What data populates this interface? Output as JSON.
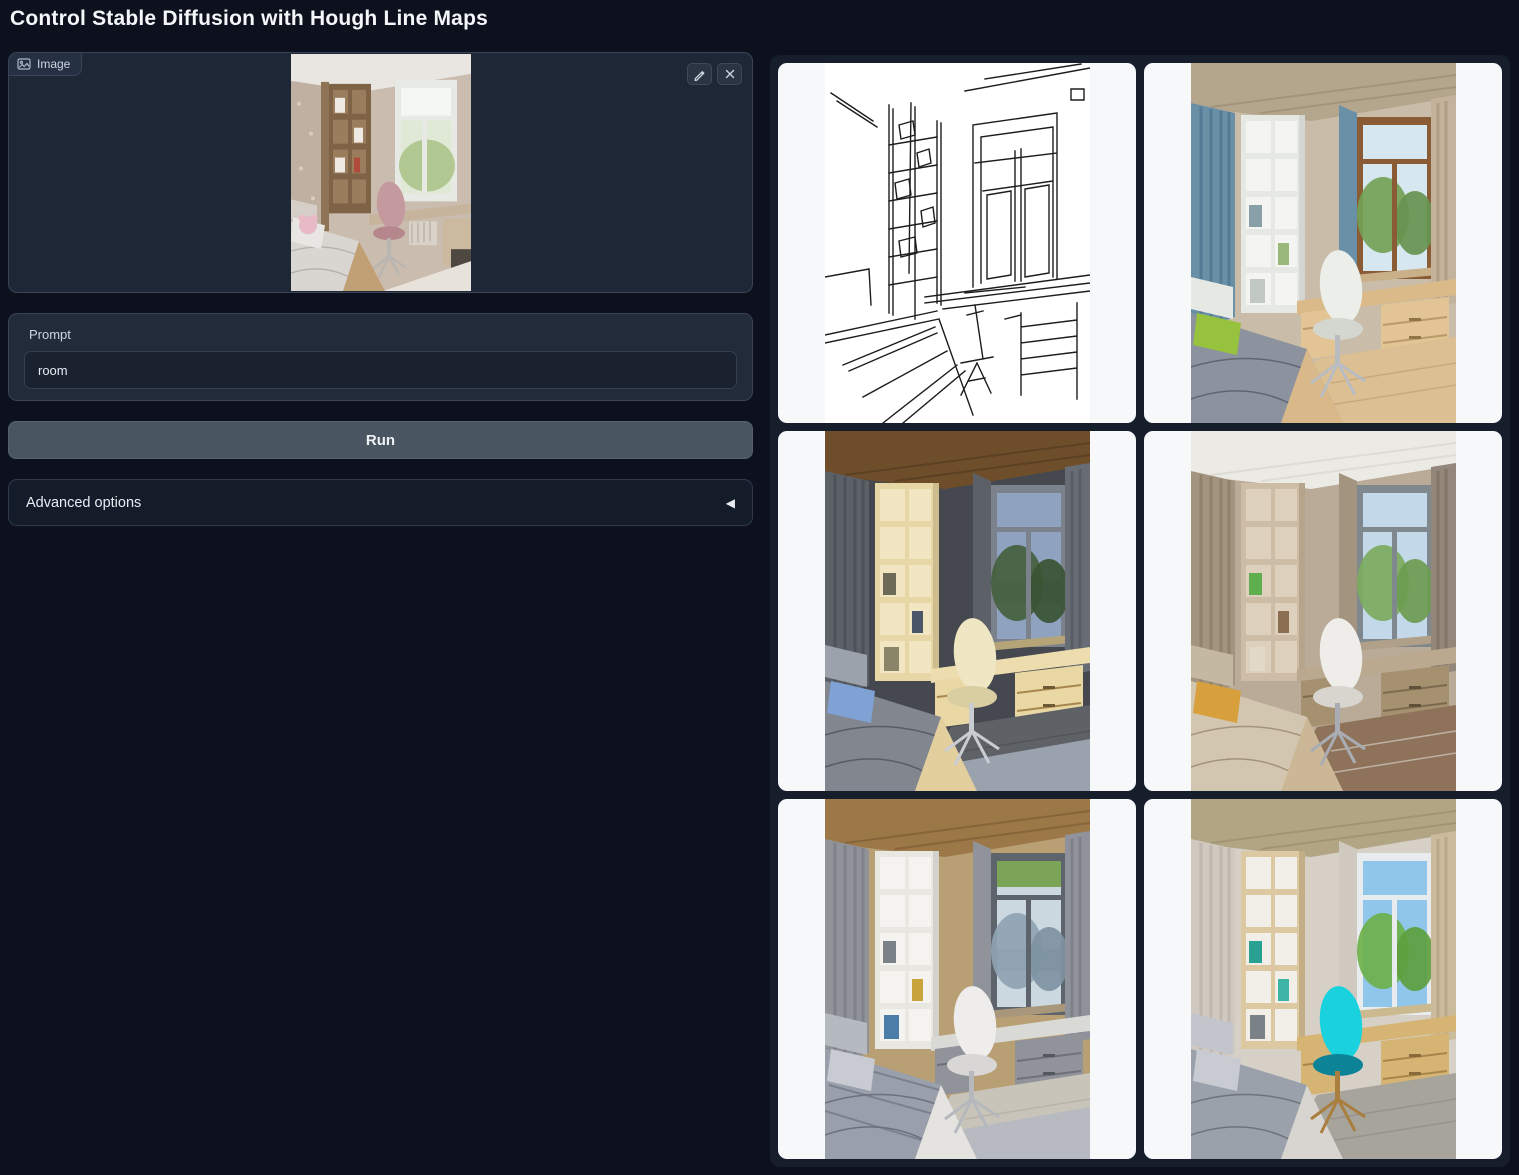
{
  "app": {
    "title": "Control Stable Diffusion with Hough Line Maps"
  },
  "image_input": {
    "label": "Image"
  },
  "prompt": {
    "label": "Prompt",
    "value": "room"
  },
  "run_button": {
    "label": "Run"
  },
  "advanced_options": {
    "label": "Advanced options",
    "arrow": "◀"
  },
  "gallery": {
    "items": [
      {
        "name": "hough-line-map"
      },
      {
        "name": "generated-room-1"
      },
      {
        "name": "generated-room-2"
      },
      {
        "name": "generated-room-3"
      },
      {
        "name": "generated-room-4"
      },
      {
        "name": "generated-room-5"
      }
    ]
  },
  "colors": {
    "page-bg": "#0c111d",
    "panel-bg": "#212b3a",
    "panel-border": "#3a4456",
    "input-bg": "#1a2230",
    "button-bg": "#4a5562",
    "card-bg": "#f7f8fa",
    "text": "#e8ecf2",
    "muted-text": "#cdd5e0",
    "accent-chair": "#1ad2de"
  }
}
